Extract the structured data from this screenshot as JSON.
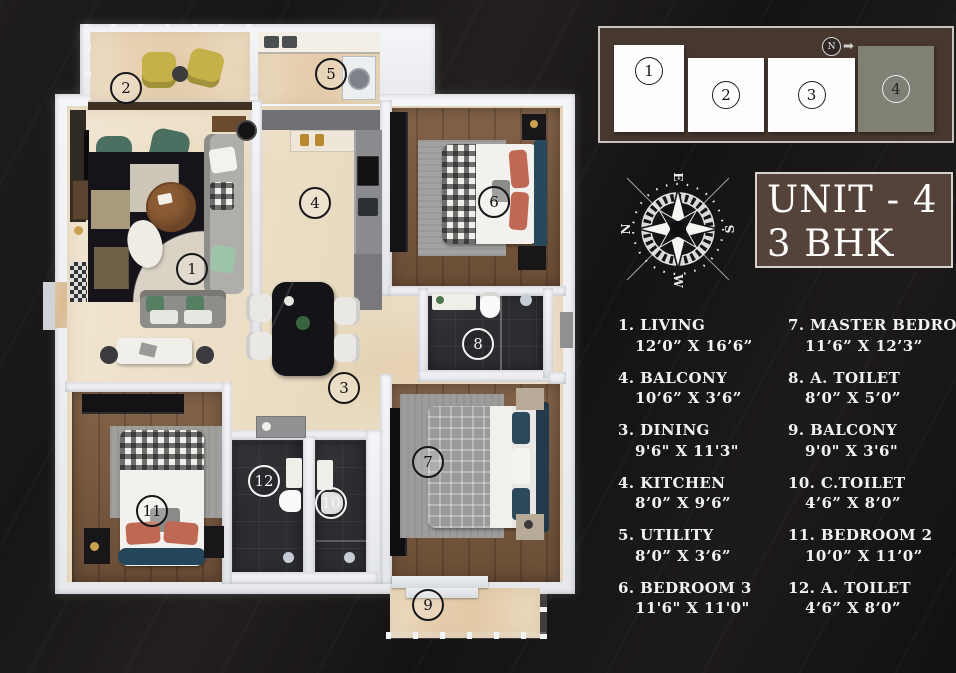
{
  "unit": {
    "line1": "UNIT - 4",
    "line2": "3 BHK"
  },
  "locator": {
    "north_label": "N",
    "units": [
      {
        "num": "1",
        "highlighted": false
      },
      {
        "num": "2",
        "highlighted": false
      },
      {
        "num": "3",
        "highlighted": false
      },
      {
        "num": "4",
        "highlighted": true
      }
    ]
  },
  "icons": {
    "north_arrow": "➡"
  },
  "compass": {
    "top": "E",
    "left": "N",
    "right": "S",
    "bottom": "W"
  },
  "legend": {
    "left": [
      {
        "num": "1.",
        "name": "LIVING",
        "dims": "12’0” X 16’6”"
      },
      {
        "num": "4.",
        "name": "BALCONY",
        "dims": "10’6” X 3’6”"
      },
      {
        "num": "3.",
        "name": "DINING",
        "dims": "9'6\" X 11'3\""
      },
      {
        "num": "4.",
        "name": "KITCHEN",
        "dims": "8’0” X 9’6”"
      },
      {
        "num": "5.",
        "name": "UTILITY",
        "dims": "8’0” X 3’6”"
      },
      {
        "num": "6.",
        "name": "BEDROOM 3",
        "dims": "11'6\" X 11'0\""
      }
    ],
    "right": [
      {
        "num": "7.",
        "name": "MASTER BEDROOM",
        "dims": "11’6” X 12’3”"
      },
      {
        "num": "8.",
        "name": "A. TOILET",
        "dims": "8’0” X 5’0”"
      },
      {
        "num": "9.",
        "name": "BALCONY",
        "dims": "9'0\" X 3'6\""
      },
      {
        "num": "10.",
        "name": "C.TOILET",
        "dims": "4’6” X 8’0”"
      },
      {
        "num": "11.",
        "name": "BEDROOM 2",
        "dims": "10’0” X 11’0”"
      },
      {
        "num": "12.",
        "name": "A. TOILET",
        "dims": "4’6” X 8’0”"
      }
    ]
  },
  "plan_markers": [
    {
      "num": "1",
      "x": 192,
      "y": 269,
      "ink": "black"
    },
    {
      "num": "2",
      "x": 126,
      "y": 88,
      "ink": "black"
    },
    {
      "num": "3",
      "x": 344,
      "y": 388,
      "ink": "black"
    },
    {
      "num": "4",
      "x": 315,
      "y": 203,
      "ink": "black"
    },
    {
      "num": "5",
      "x": 331,
      "y": 74,
      "ink": "black"
    },
    {
      "num": "6",
      "x": 494,
      "y": 202,
      "ink": "black"
    },
    {
      "num": "7",
      "x": 428,
      "y": 462,
      "ink": "black"
    },
    {
      "num": "8",
      "x": 478,
      "y": 344,
      "ink": "white"
    },
    {
      "num": "9",
      "x": 428,
      "y": 605,
      "ink": "black"
    },
    {
      "num": "10",
      "x": 331,
      "y": 503,
      "ink": "white"
    },
    {
      "num": "11",
      "x": 152,
      "y": 511,
      "ink": "black"
    },
    {
      "num": "12",
      "x": 264,
      "y": 481,
      "ink": "white"
    }
  ],
  "colors": {
    "panel_brown": "#46372f",
    "unit_box_brown": "#55433b",
    "highlight_unit_gray": "#818074",
    "marble_floor": "#ecdfc9",
    "wood_floor": "#7c5a3f",
    "dark_tile_floor": "#2c2d31"
  }
}
